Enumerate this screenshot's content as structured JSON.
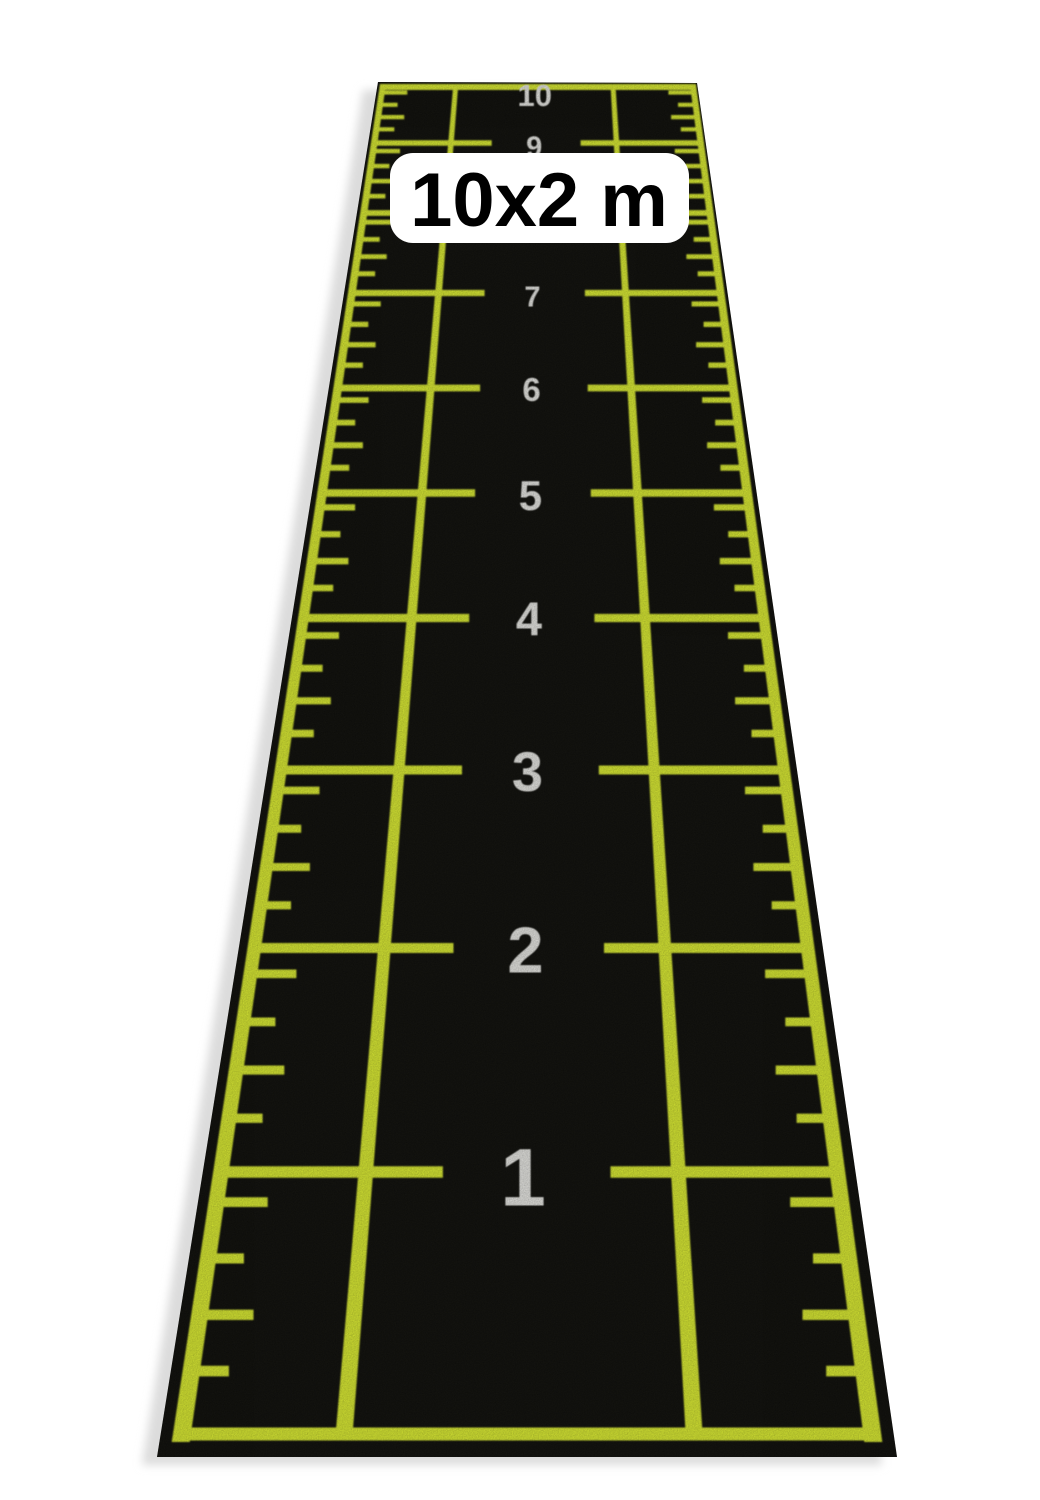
{
  "product": {
    "size_label": "10x2 m"
  },
  "mat": {
    "colors": {
      "page_background": "#ffffff",
      "surface": "#0c0c0a",
      "line": "#e2f433",
      "number": "#f0f0ee",
      "shadow": "#dcdcdc",
      "label_background": "#ffffff",
      "label_text": "#000000"
    },
    "corners": {
      "top_left": [
        378,
        82
      ],
      "top_right": [
        697,
        83
      ],
      "bottom_right": [
        897,
        1457
      ],
      "bottom_left": [
        157,
        1457
      ]
    },
    "shadow_offset": [
      -15,
      8
    ],
    "border": {
      "left_top": [
        383,
        84
      ],
      "left_bottom": [
        181,
        1440
      ],
      "right_top": [
        693,
        85
      ],
      "right_bottom": [
        873,
        1440
      ],
      "top_y": 87,
      "bottom_y": 1434,
      "top_thickness": 6,
      "bottom_thickness": 13
    },
    "lanes": {
      "left_u": 0.235,
      "right_u": 0.742
    },
    "segments": {
      "left": [
        0.0,
        0.36
      ],
      "right": [
        0.632,
        1.0
      ]
    },
    "ticks": {
      "fractions_below_upper_line": [
        0.115,
        0.33,
        0.545,
        0.76
      ],
      "long_len_u": 0.082,
      "short_len_u": 0.056
    },
    "number_u": 0.49,
    "meters": [
      {
        "v": 0,
        "label": "",
        "line_y": 1434,
        "number_y": 0,
        "font": 0
      },
      {
        "v": 1,
        "label": "1",
        "line_y": 1172,
        "number_y": 1176,
        "font": 82
      },
      {
        "v": 2,
        "label": "2",
        "line_y": 948,
        "number_y": 949,
        "font": 65
      },
      {
        "v": 3,
        "label": "3",
        "line_y": 770,
        "number_y": 771,
        "font": 56
      },
      {
        "v": 4,
        "label": "4",
        "line_y": 618,
        "number_y": 618,
        "font": 47
      },
      {
        "v": 5,
        "label": "5",
        "line_y": 493,
        "number_y": 495,
        "font": 42
      },
      {
        "v": 6,
        "label": "6",
        "line_y": 388,
        "number_y": 389,
        "font": 33
      },
      {
        "v": 7,
        "label": "7",
        "line_y": 293,
        "number_y": 296,
        "font": 29
      },
      {
        "v": 8,
        "label": "8",
        "line_y": 213,
        "number_y": 215,
        "font": 29
      },
      {
        "v": 9,
        "label": "9",
        "line_y": 143,
        "number_y": 146,
        "font": 29
      },
      {
        "v": 10,
        "label": "10",
        "line_y": 86,
        "number_y": 95,
        "font": 31
      }
    ]
  }
}
